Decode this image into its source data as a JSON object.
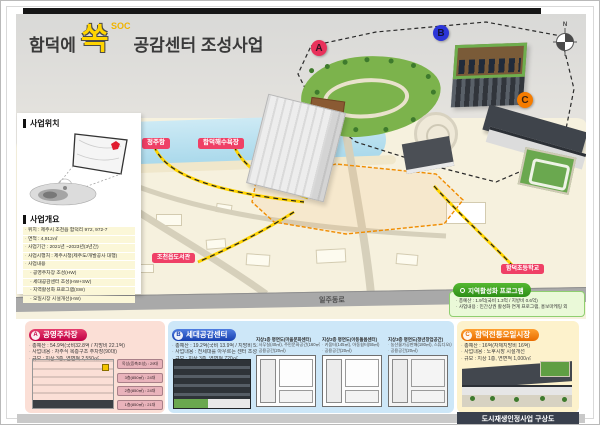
{
  "header": {
    "title_prefix": "함덕에",
    "title_highlight": "쏙",
    "title_super": "SOC",
    "title_suffix": "공감센터 조성사업"
  },
  "sidebar": {
    "location_heading": "사업위치",
    "overview_heading": "사업개요",
    "overview_items": [
      "위치 : 제주시 조천읍 함덕리 972, 972-7",
      "면적 : 4,912㎡",
      "사업기간 : 2021년 ~2023년(3년간)",
      "사업시행처 : 제주시청(제주도/개발공사 대행)",
      "사업내용"
    ],
    "overview_sub_items": [
      "공영주차장 조성(HW)",
      "세대공감센터 조성(HW+SW)",
      "지역활성화 프로그램(SW)",
      "오일시장 시설개선(HW)"
    ]
  },
  "map": {
    "compass_label": "N",
    "labels": {
      "port": "정주항",
      "beach": "함덕해수욕장",
      "library": "조천읍도서관",
      "school": "함덕초등학교",
      "road": "일주동로"
    },
    "markers": {
      "a": "A",
      "b": "B",
      "c": "C"
    },
    "program_box": {
      "title": "지역활성화 프로그램",
      "lines": [
        "총예산 : 1.9억(국비 1.3억 / 지방비 0.6억)",
        "사업내용 : 민간상권 활성화 연계 프로그램, 홍보마케팅 외"
      ]
    }
  },
  "panels": {
    "parking": {
      "marker": "A",
      "title": "공영주차장",
      "lines": [
        "총예산 : 54.9억(국비32.8억 / 지방비 22.1억)",
        "사업내용 : 자주식 복층구조 주차장(90대)",
        "규모 : 지상 3층, 연면적 2,550㎡"
      ],
      "floor_tags": [
        "옥상(증축조성) : 29대",
        "3층(850㎡) : 24대",
        "2층(850㎡) : 24대",
        "1층(850㎡) : 21대"
      ]
    },
    "center": {
      "marker": "B",
      "title": "세대공감센터",
      "lines": [
        "총예산 : 19.2억(국비 13.9억 / 지방비 5.3억)",
        "사업내용 : 전세대를 아우르는 센터 조성",
        "규모 : 지상 3층, 연면적 720㎡"
      ],
      "plans": [
        {
          "title": "지상1층 평면도(마을문화센터)",
          "line1": "사무실(40㎡), 주민문화공간(160㎡)",
          "line2": "공용공간(20㎡)"
        },
        {
          "title": "지상2층 평면도(아동돌봄센터)",
          "line1": "키움터(145㎡), 아동쉼터(55㎡)",
          "line2": "공용공간(20㎡)"
        },
        {
          "title": "지상3층 평면도(청년창업공간)",
          "line1": "농산물가공판매(180㎡), 스튜디오(40㎡)",
          "line2": "공용공간(20㎡)"
        }
      ]
    },
    "market": {
      "marker": "C",
      "title": "함덕전통오일시장",
      "lines": [
        "총예산 : 16억(자체지방비 16억)",
        "사업내용 : 노후시장 시설개선",
        "규모 : 지상 1층, 연면적 1,000㎡"
      ]
    }
  },
  "footer": {
    "label": "도시재생인정사업 구상도"
  },
  "colors": {
    "marker_a": "#e8315b",
    "marker_b": "#2b35d8",
    "marker_c": "#f57c00",
    "label_pill": "#ef4066",
    "panel_a_header": "#d11050",
    "panel_b_header": "#1b50c8",
    "panel_c_header": "#f07c00",
    "program_green": "#2f9e1f",
    "title_yellow": "#ffd400"
  }
}
